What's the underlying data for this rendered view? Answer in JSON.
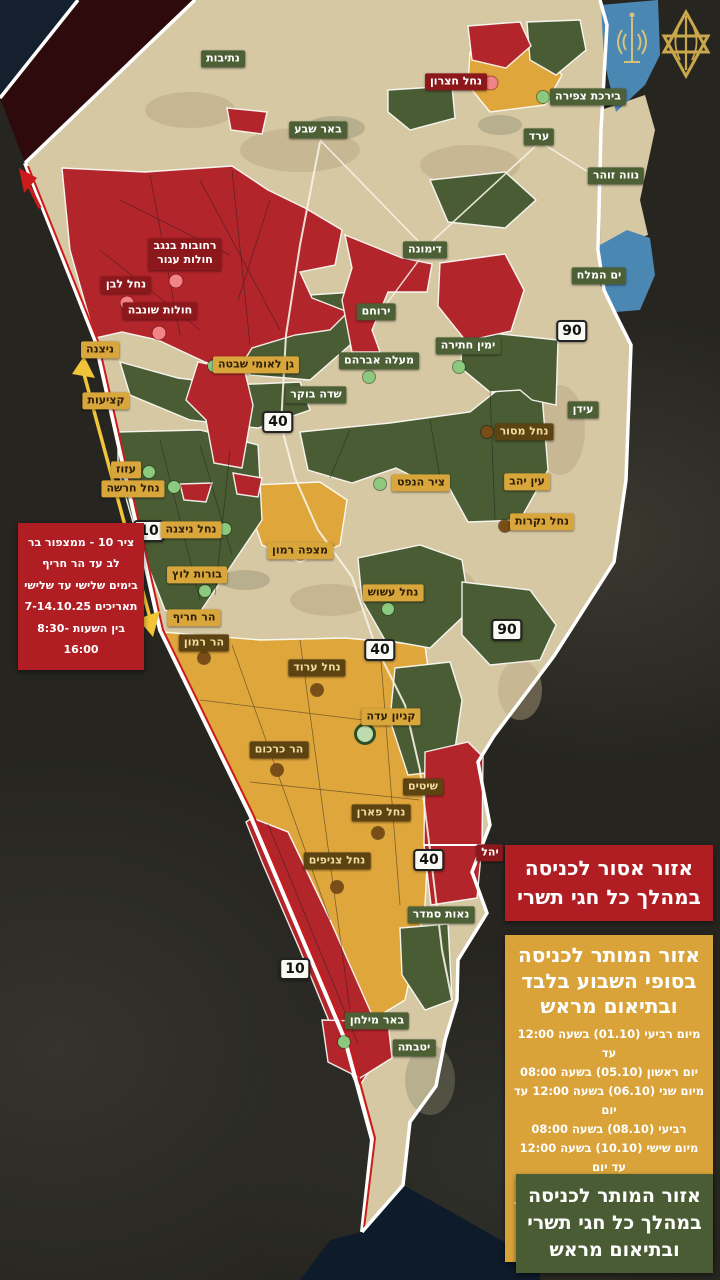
{
  "colors": {
    "zone_forbidden_red": "#b2252b",
    "zone_weekend_yellow": "#dfa63c",
    "zone_allowed_green": "#4a5c33",
    "border_red_line": "#cc1b1b",
    "dead_sea_blue": "#4b87b3",
    "land_beige": "#d7c8a4",
    "gaza_maroon": "#2e0a0d"
  },
  "map": {
    "routes": {
      "r90": "90",
      "r40": "40",
      "r10": "10"
    },
    "labels": [
      {
        "text": "נתיבות"
      },
      {
        "text": "באר שבע"
      },
      {
        "text": "ערד"
      },
      {
        "text": "נווה זוהר"
      },
      {
        "text": "בירכת צפירה"
      },
      {
        "text": "דימונה"
      },
      {
        "text": "ירוחם"
      },
      {
        "text": "מעלה אברהם"
      },
      {
        "text": "ימין חתירה"
      },
      {
        "text": "שדה בוקר"
      },
      {
        "text": "ים המלח"
      },
      {
        "text": "עידן"
      },
      {
        "text": "נאות סמדר"
      },
      {
        "text": "באר מילחן"
      },
      {
        "text": "יטבתה"
      },
      {
        "text": "ניצנה"
      },
      {
        "text": "קציעות"
      },
      {
        "text": "עזוז"
      },
      {
        "text": "נחל חרשה"
      },
      {
        "text": "נחל ניצנה"
      },
      {
        "text": "בורות לוץ"
      },
      {
        "text": "הר חריף"
      },
      {
        "text": "מצפה רמון"
      },
      {
        "text": "ציר הנפט"
      },
      {
        "text": "נחל עשוש"
      },
      {
        "text": "גן לאומי שבטה"
      },
      {
        "text": "עין יהב"
      },
      {
        "text": "נחל נקרות"
      },
      {
        "text": "קניון עדה"
      },
      {
        "text": "נחל מסור"
      },
      {
        "text": "הר רמון"
      },
      {
        "text": "נחל ערוד"
      },
      {
        "text": "הר כרכום"
      },
      {
        "text": "שיטים"
      },
      {
        "text": "נחל פארן"
      },
      {
        "text": "נחל צניפים"
      },
      {
        "text": "יהל"
      },
      {
        "text": "נחל חצרון"
      },
      {
        "text": "רחובות בנגב\nחולות עגור"
      },
      {
        "text": "נחל לבן"
      },
      {
        "text": "חולות שונבה"
      }
    ]
  },
  "notice": {
    "lines": [
      "ציר 10 - ממצפור בר",
      "לב עד הר חריף",
      "בימים שלישי עד שלישי",
      "תאריכים 7-14.10.25",
      "בין השעות 8:30-16:00"
    ]
  },
  "legend": {
    "forbidden": {
      "title": "אזור אסור לכניסה במהלך כל חגי תשרי"
    },
    "weekend": {
      "title": "אזור המותר לכניסה בסופי השבוע בלבד ובתיאום מראש",
      "lines": [
        "מיום רביעי (01.10) בשעה 12:00 עד",
        "יום ראשון (05.10) בשעה 08:00",
        "מיום שני (06.10) בשעה 12:00 עד יום",
        "רביעי (08.10) בשעה 08:00",
        "מיום שישי (10.10) בשעה 12:00 עד יום",
        "ראשון (12.10) בשעה 08:00",
        "מיום שני (13.10) בשעה 12:00 עד יום",
        "רביעי (15.10) בשעה 08:00"
      ]
    },
    "allowed": {
      "title": "אזור המותר לכניסה במהלך כל חגי תשרי ובתיאום מראש"
    }
  }
}
